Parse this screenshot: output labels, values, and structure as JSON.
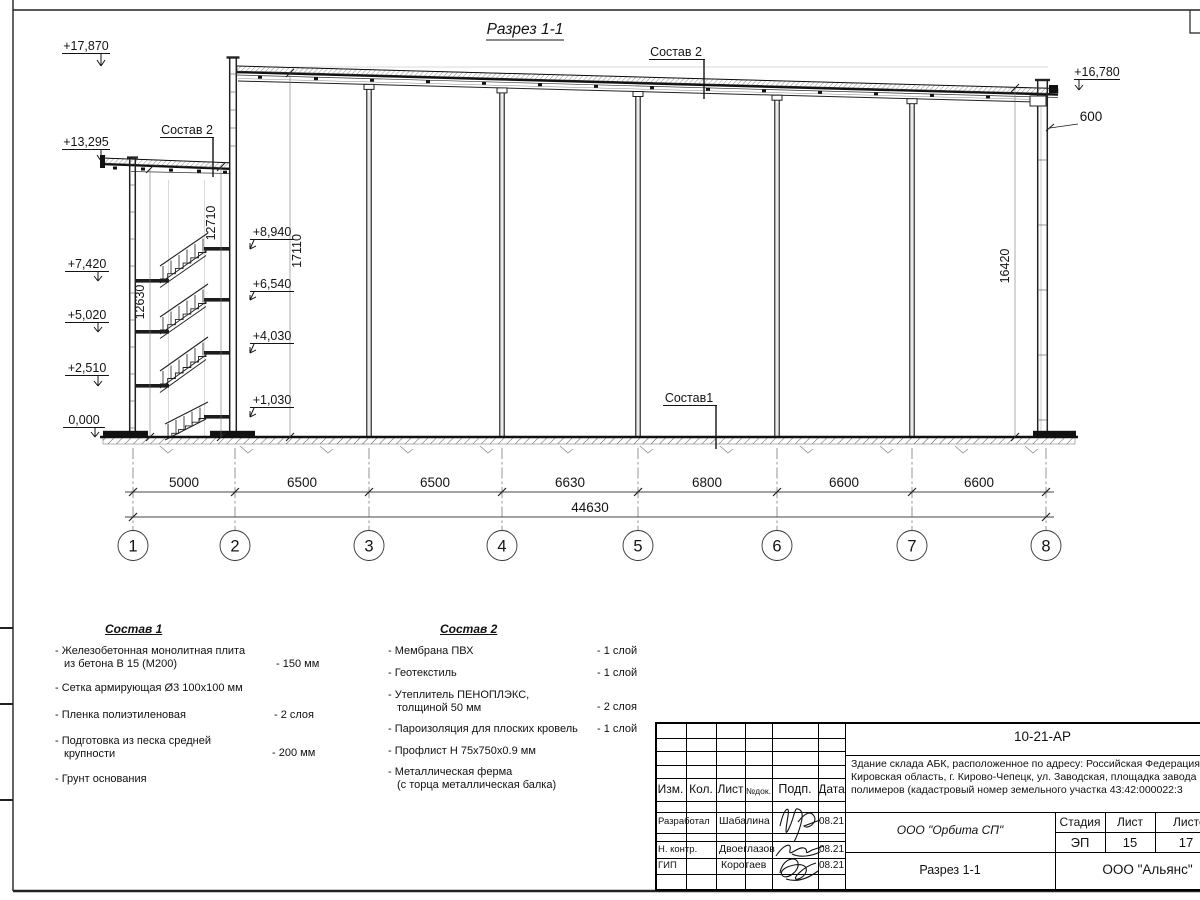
{
  "sheet": {
    "title": "Разрез 1-1"
  },
  "elevations": {
    "left": [
      "+17,870",
      "+13,295",
      "+7,420",
      "+5,020",
      "+2,510",
      "0,000"
    ],
    "stair": [
      "+8,940",
      "+6,540",
      "+4,030",
      "+1,030"
    ],
    "right_top": "+16,780",
    "parapet_dim": "600"
  },
  "vertical_dims": {
    "d12710": "12710",
    "d17110": "17110",
    "d12630": "12630",
    "d16420": "16420"
  },
  "axis_dims": {
    "segments": [
      "5000",
      "6500",
      "6500",
      "6630",
      "6800",
      "6600",
      "6600"
    ],
    "total": "44630"
  },
  "grid_axes": [
    "1",
    "2",
    "3",
    "4",
    "5",
    "6",
    "7",
    "8"
  ],
  "callouts": {
    "sostav2_top": "Состав 2",
    "sostav2_left": "Состав 2",
    "sostav1": "Состав1"
  },
  "composition1": {
    "title": "Состав 1",
    "items": [
      {
        "name": "- Железобетонная  монолитная плита",
        "name2": "из бетона В 15 (М200)",
        "value": "- 150 мм"
      },
      {
        "name": "- Сетка армирующая Ø3 100х100 мм",
        "name2": "",
        "value": ""
      },
      {
        "name": "- Пленка полиэтиленовая",
        "name2": "",
        "value": "-  2 слоя"
      },
      {
        "name": "- Подготовка из песка средней",
        "name2": "крупности",
        "value": "- 200 мм"
      },
      {
        "name": "- Грунт основания",
        "name2": "",
        "value": ""
      }
    ]
  },
  "composition2": {
    "title": "Состав 2",
    "items": [
      {
        "name": "- Мембрана ПВХ",
        "name2": "",
        "value": "- 1 слой"
      },
      {
        "name": "- Геотекстиль",
        "name2": "",
        "value": "- 1 слой"
      },
      {
        "name": "- Утеплитель ПЕНОПЛЭКС,",
        "name2": "толщиной 50 мм",
        "value": "- 2 слоя"
      },
      {
        "name": "- Пароизоляция для плоских кровель",
        "name2": "",
        "value": "- 1 слой"
      },
      {
        "name": "- Профлист Н 75х750х0.9 мм",
        "name2": "",
        "value": ""
      },
      {
        "name": "- Металлическая ферма",
        "name2": "(с торца металлическая балка)",
        "value": ""
      }
    ]
  },
  "title_block": {
    "doc_number": "10-21-АР",
    "description_line1": "Здание склада АБК, расположенное по адресу: Российская Федерация,",
    "description_line2": "Кировская область, г. Кирово-Чепецк, ул. Заводская, площадка завода",
    "description_line3": "полимеров (кадастровый номер земельного участка 43:42:000022:3",
    "columns": {
      "izm": "Изм.",
      "kol": "Кол.",
      "list": "Лист",
      "ndoc": "№док.",
      "podp": "Подп.",
      "data": "Дата"
    },
    "rows": [
      {
        "role": "Разработал",
        "name": "Шабалина",
        "date": "08.21"
      },
      {
        "role": "Н. контр.",
        "name": "Двоеглазов",
        "date": "08.21"
      },
      {
        "role": "ГИП",
        "name": "Коротаев",
        "date": "08.21"
      }
    ],
    "org": "ООО \"Орбита СП\"",
    "stage_label": "Стадия",
    "sheet_label": "Лист",
    "sheets_label": "Листов",
    "stage": "ЭП",
    "sheet_num": "15",
    "sheets_total": "17",
    "drawing_name": "Разрез 1-1",
    "contractor": "ООО \"Альянс\""
  }
}
